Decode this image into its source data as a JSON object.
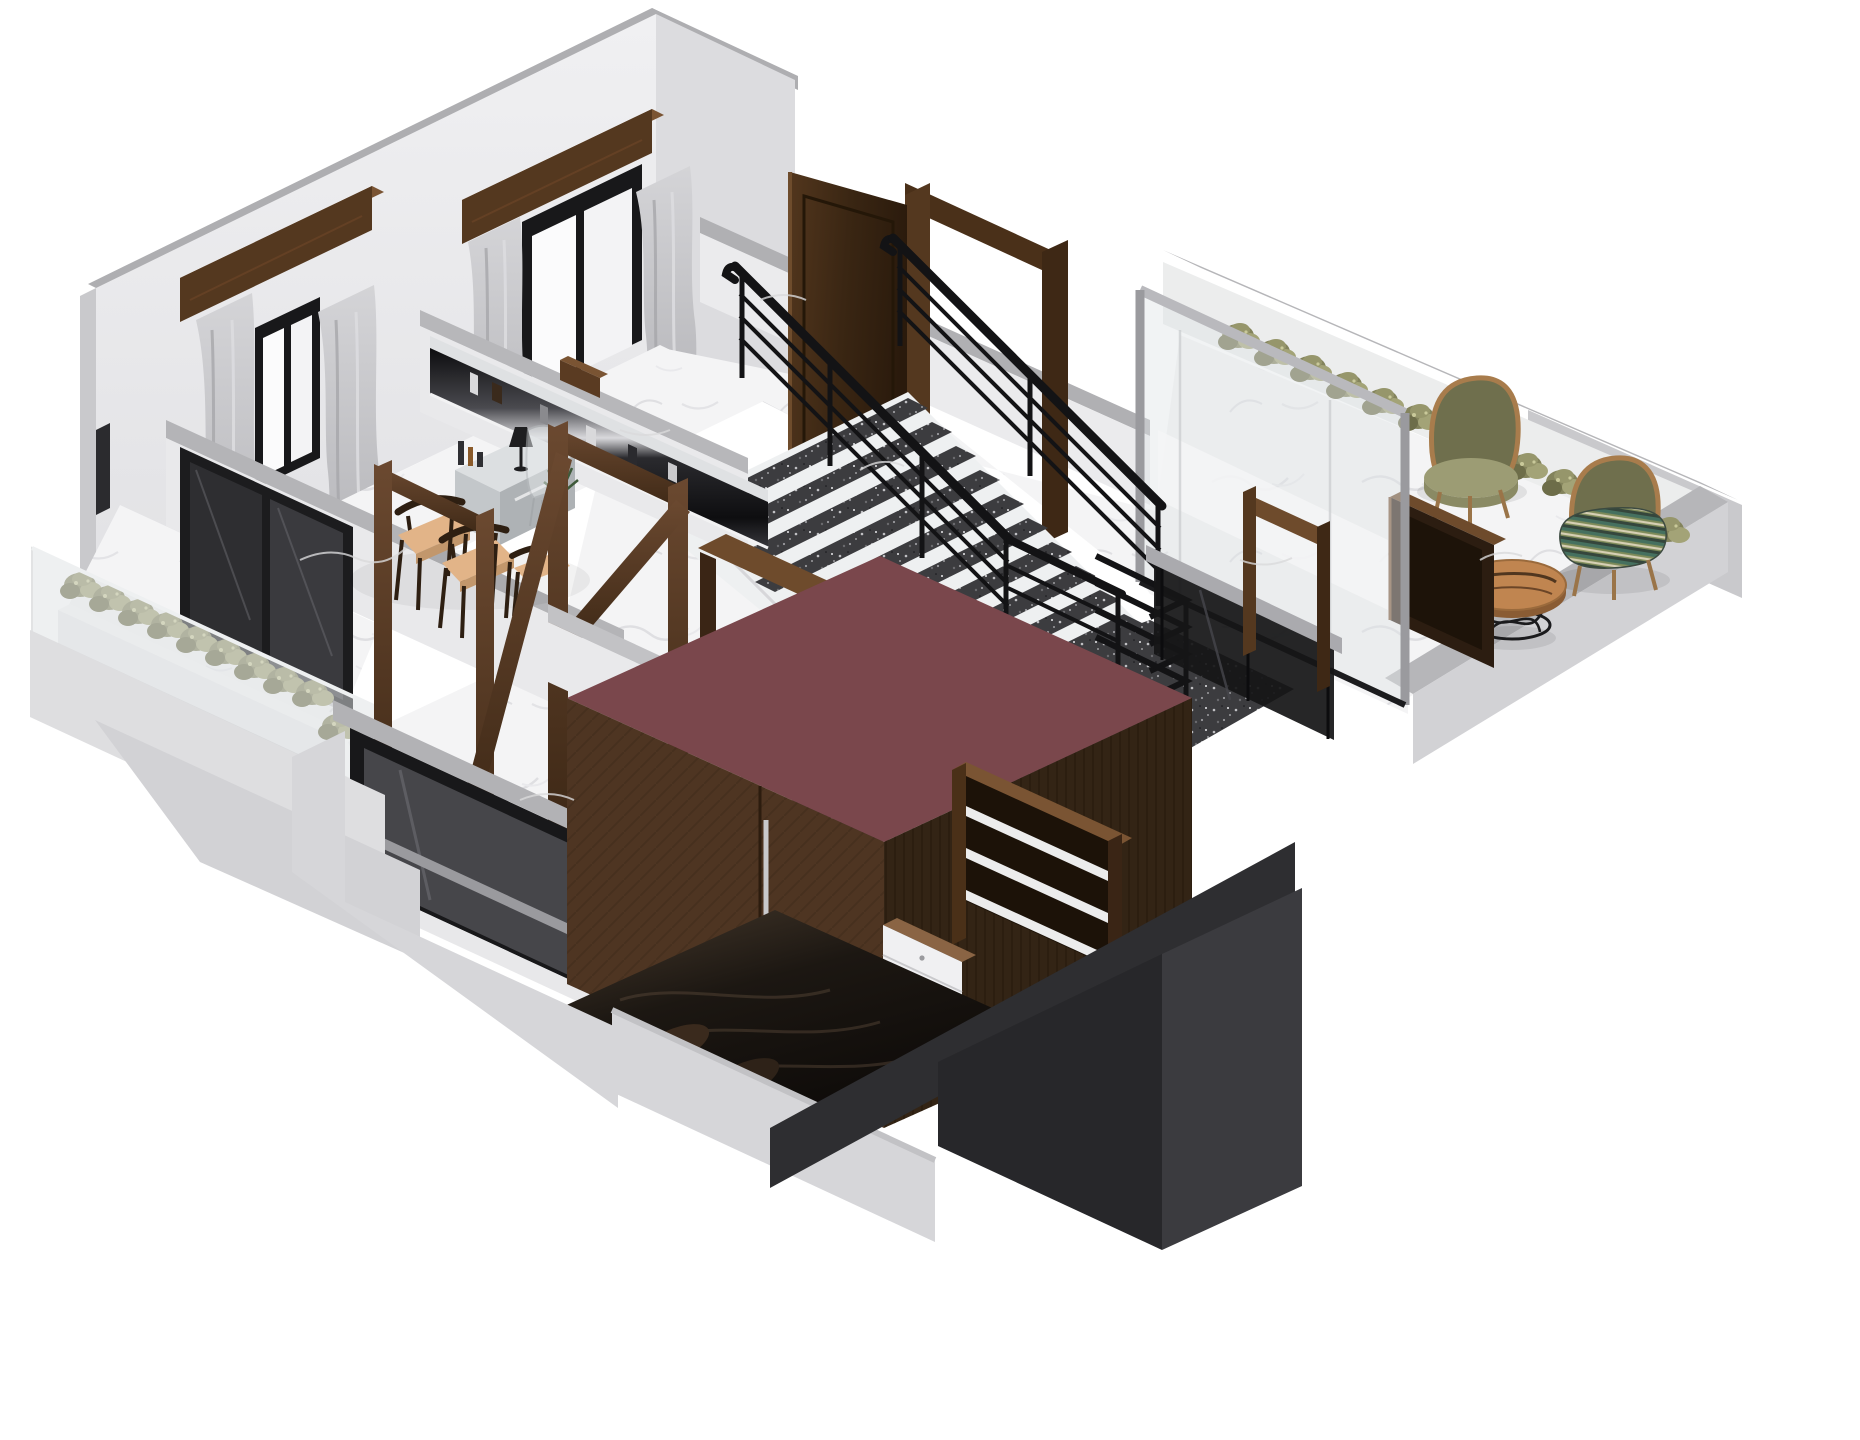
{
  "scene": {
    "kind": "isometric-architectural-render",
    "subject": "cutaway 3D floor plan of a duplex apartment upper floor",
    "background": "#ffffff",
    "visible_text": "none"
  },
  "colors": {
    "background": "#ffffff",
    "wall_face": "#ebebed",
    "wall_face_shade": "#d7d7da",
    "wall_cap": "#aeaeb1",
    "wall_end": "#c9c9cc",
    "slab_light": "#d6d6d9",
    "slab_mid": "#c2c2c5",
    "floor_marble": "#f4f4f5",
    "marble_vein": "#dfdfe2",
    "window_frame": "#18181a",
    "glass_white": "#fbfbfc",
    "curtain": "#c7c7ca",
    "curtain_shadow": "#a6a6aa",
    "pelmet_front": "#54381f",
    "pelmet_top": "#7a5433",
    "walnut": "#4e3522",
    "walnut_side": "#332415",
    "walnut_deep": "#241708",
    "walnut_light": "#6e4b2c",
    "stair_tread": "#3c3c3f",
    "stair_white": "#eef0f1",
    "railing_black": "#131315",
    "balustrade_glass": "#151517",
    "balustrade_cap": "#aaaaae",
    "maroon_top": "#7a474c",
    "bed_dark": "#171310",
    "pillow_brown": "#3a2a1d",
    "seat_tan": "#e2b488",
    "seat_tan_side": "#c2976c",
    "chair_wood": "#2e1f12",
    "chrome_hi": "#dfe1e3",
    "hedge_dark": "#6d6d49",
    "hedge_mid": "#83835c",
    "hedge_light": "#a3a377",
    "olive_shell": "#6f6f4d",
    "olive_rim": "#a87c4c",
    "cushion_olive": "#9c9c74",
    "table_wood": "#c08550",
    "table_edge": "#8a5c34",
    "wire_black": "#1b1b1d",
    "core_band": "#2e2e31",
    "core_dark": "#27272a",
    "core_mid": "#3b3b3f",
    "drawer_white": "#f0f0f2",
    "drawer_top": "#8a6444",
    "shelf_white": "#ececec",
    "lamp_black": "#1e1e20",
    "plant_green": "#3e5a3a"
  },
  "elements": {
    "living_dining": [
      "back wall with two windows",
      "wood pelmets",
      "gray curtains",
      "three walnut dining chairs with tan seats",
      "mirrored vanity desk",
      "transparent ghost chair",
      "black table lamp",
      "small plant",
      "long chrome wall console with books",
      "walnut frame partitions"
    ],
    "stair_hall": [
      "straight staircase with dark carpet treads",
      "black metal railings",
      "open walnut door",
      "framed glass partition",
      "speckled landing",
      "black glass balustrade",
      "walnut standing mirror"
    ],
    "terrace": [
      "white parapet walls",
      "hedge shrubs",
      "olive lounge chair",
      "striped-cushion lounge chair",
      "round live-edge coffee table with wire base",
      "dark walnut cabinet"
    ],
    "bedroom": [
      "black framed picture window",
      "dark glossy bed",
      "wardrobe with maroon top and chevron doors",
      "walnut open shelf unit",
      "white dresser drawers"
    ],
    "balcony": [
      "glass railing",
      "long white planter with shrubs",
      "dark sliding glass door"
    ],
    "structure": [
      "white marble floors",
      "gray floor slabs",
      "dark service core below"
    ]
  }
}
